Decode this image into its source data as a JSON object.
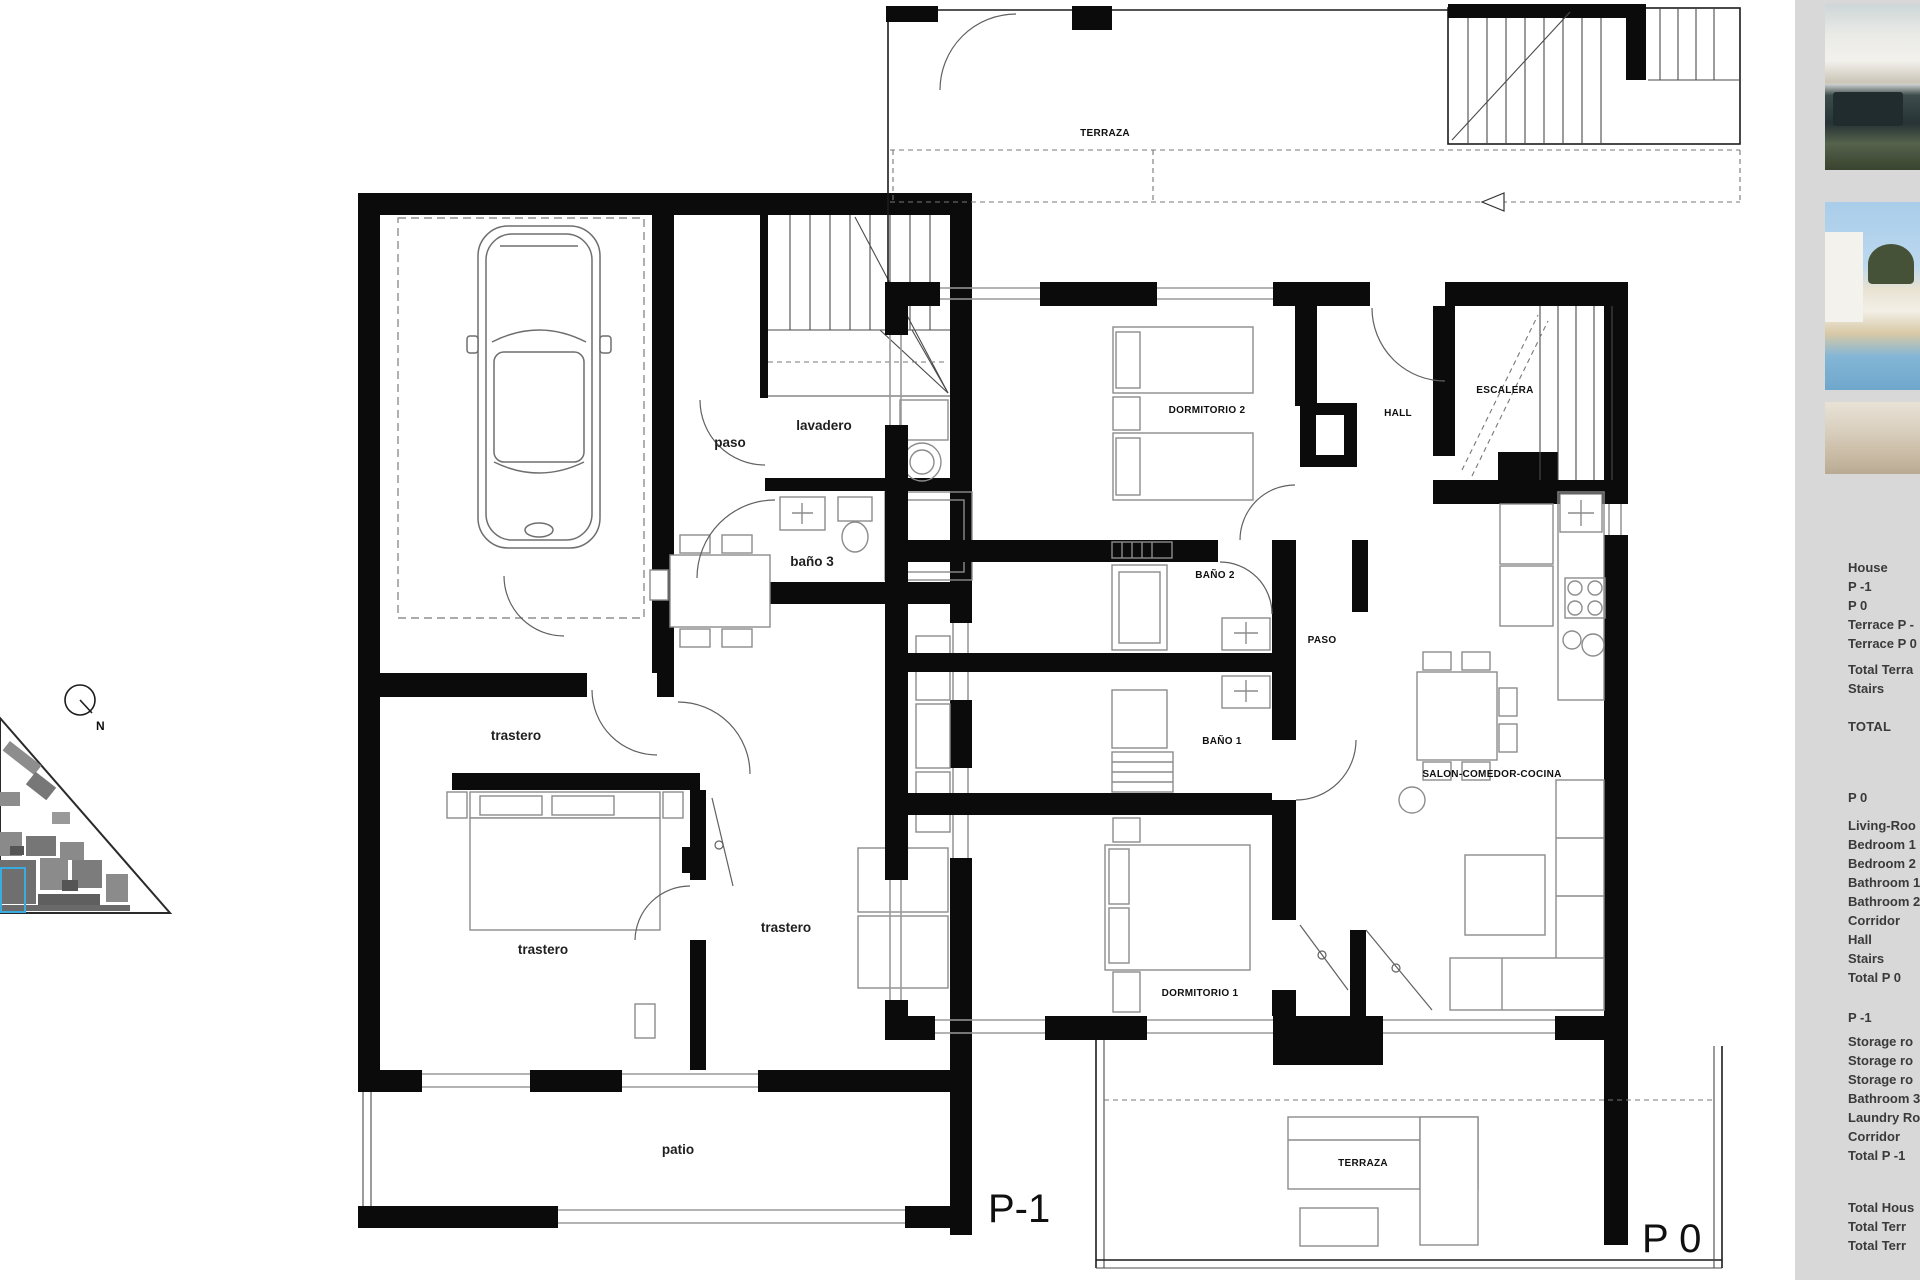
{
  "site_plan": {
    "north_label": "N"
  },
  "plans": {
    "p1": {
      "floor_label": "P-1",
      "rooms": {
        "paso": "paso",
        "lavadero": "lavadero",
        "bano3": "baño 3",
        "trastero_a": "trastero",
        "trastero_b": "trastero",
        "trastero_c": "trastero",
        "patio": "patio"
      }
    },
    "p0": {
      "floor_label": "P 0",
      "rooms": {
        "terraza_top": "TERRAZA",
        "dormitorio2": "DORMITORIO 2",
        "hall": "HALL",
        "escalera": "ESCALERA",
        "bano2": "BAÑO 2",
        "paso": "PASO",
        "bano1": "BAÑO 1",
        "salon": "SALON-COMEDOR-COCINA",
        "dormitorio1": "DORMITORIO 1",
        "terraza_bottom": "TERRAZA"
      }
    }
  },
  "sidebar": {
    "summary_lines": [
      "House",
      "P -1",
      "P 0",
      "Terrace P -",
      "Terrace P 0",
      "Total Terra",
      "Stairs"
    ],
    "total_label": "TOTAL",
    "p0_heading": "P 0",
    "p0_lines": [
      "Living-Roo",
      "Bedroom 1",
      "Bedroom 2",
      "Bathroom 1",
      "Bathroom 2",
      "Corridor",
      "Hall",
      "Stairs",
      "Total P 0"
    ],
    "p1_heading": "P -1",
    "p1_lines": [
      "Storage ro",
      "Storage ro",
      "Storage ro",
      "Bathroom 3",
      "Laundry Ro",
      "Corridor",
      "Total P -1"
    ],
    "total_lines": [
      "Total Hous",
      "Total Terr",
      "Total Terr"
    ]
  },
  "colors": {
    "wall": "#0b0b0b",
    "furniture_line": "#8c8c8c",
    "panel_bg": "#d8d8d8",
    "text": "#3a3a3a",
    "highlight_blue": "#3aabdf"
  }
}
